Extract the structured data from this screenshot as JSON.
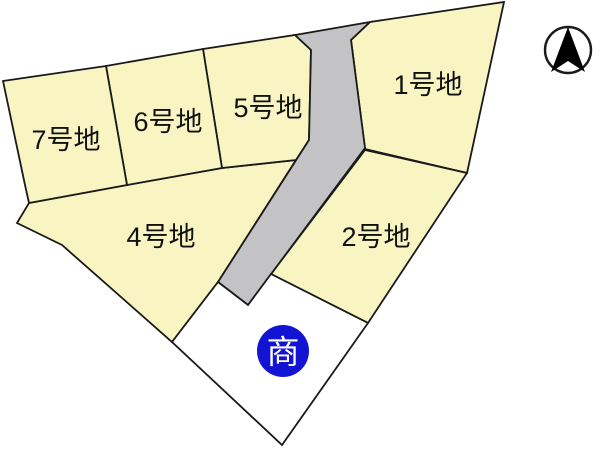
{
  "colors": {
    "background": "#ffffff",
    "lot_fill": "#f8f5c3",
    "road_fill": "#c3c3c5",
    "commercial_fill": "#ffffff",
    "outline": "#1a1a1a",
    "label_color": "#111111",
    "badge_bg": "#1313d3",
    "badge_text": "#ffffff",
    "compass_fill": "#000000"
  },
  "lots": [
    {
      "id": "lot-1",
      "label": "1号地",
      "points": "370,22 504,2 467,173 365,149 351,40",
      "label_x": 428,
      "label_y": 85
    },
    {
      "id": "lot-2",
      "label": "2号地",
      "points": "365,150 467,173 368,323 271,274",
      "label_x": 376,
      "label_y": 237
    },
    {
      "id": "lot-4",
      "label": "4号地",
      "points": "29,203 127,185 222,168 296,160 218,282 172,342 62,245 17,223",
      "label_x": 161,
      "label_y": 237
    },
    {
      "id": "lot-5",
      "label": "5号地",
      "points": "203,49 295,35 311,50 309,140 296,160 222,168",
      "label_x": 268,
      "label_y": 108
    },
    {
      "id": "lot-6",
      "label": "6号地",
      "points": "106,66 203,49 222,168 127,185",
      "label_x": 168,
      "label_y": 122
    },
    {
      "id": "lot-7",
      "label": "7号地",
      "points": "3,81 106,66 127,185 29,203 25,185",
      "label_x": 66,
      "label_y": 140
    }
  ],
  "road": {
    "id": "road",
    "points": "295,35 370,22 351,40 365,148 248,305 218,282 309,140 311,50"
  },
  "commercial_lot": {
    "id": "commercial-lot",
    "points": "172,342 218,282 248,305 271,274 368,323 282,445",
    "badge": {
      "label": "商",
      "cx": 283,
      "cy": 351,
      "r": 26
    }
  },
  "compass": {
    "cx": 568,
    "cy": 50,
    "r": 23,
    "arrow_path": "M 568 27 L 585 72 L 568 61 L 551 72 Z"
  }
}
